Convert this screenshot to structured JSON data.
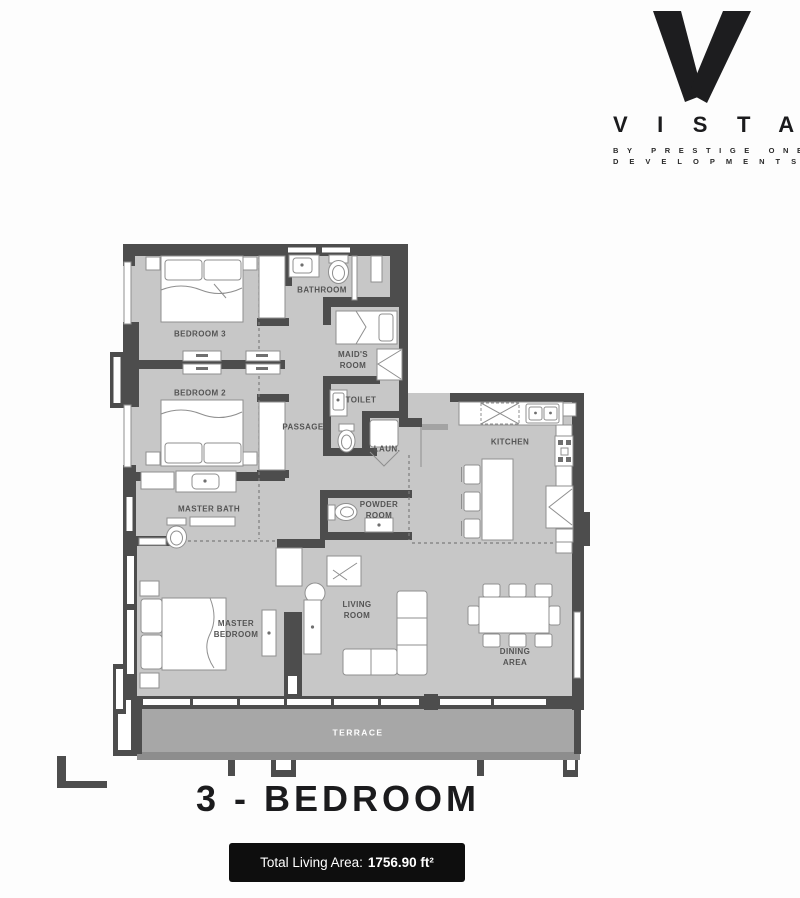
{
  "brand": {
    "name": "VISTA",
    "tagline_line1": "BY PRESTIGE ONE",
    "tagline_line2": "DEVELOPMENTS"
  },
  "plan": {
    "rooms": {
      "bedroom3": "BEDROOM 3",
      "bathroom": "BATHROOM",
      "maids_room": "MAID'S\nROOM",
      "bedroom2": "BEDROOM 2",
      "passage": "PASSAGE",
      "toilet": "TOILET",
      "laundry": "LAUN.",
      "kitchen": "KITCHEN",
      "master_bath": "MASTER BATH",
      "powder_room": "POWDER\nROOM",
      "master_bedroom": "MASTER\nBEDROOM",
      "living_room": "LIVING\nROOM",
      "dining_area": "DINING\nAREA",
      "terrace": "TERRACE"
    }
  },
  "footer": {
    "title": "3 - BEDROOM"
  },
  "badge": {
    "label": "Total Living Area:",
    "value": "1756.90 ft²"
  },
  "colors": {
    "wall": "#4d4d4d",
    "floor": "#c7c7c7",
    "terrace": "#a7a7a7",
    "terrace_edge": "#8d8d8d",
    "stroke": "#8f8f8f",
    "label": "#545454",
    "badge_bg": "#0e0e0e",
    "ink": "#1b1b1d"
  }
}
